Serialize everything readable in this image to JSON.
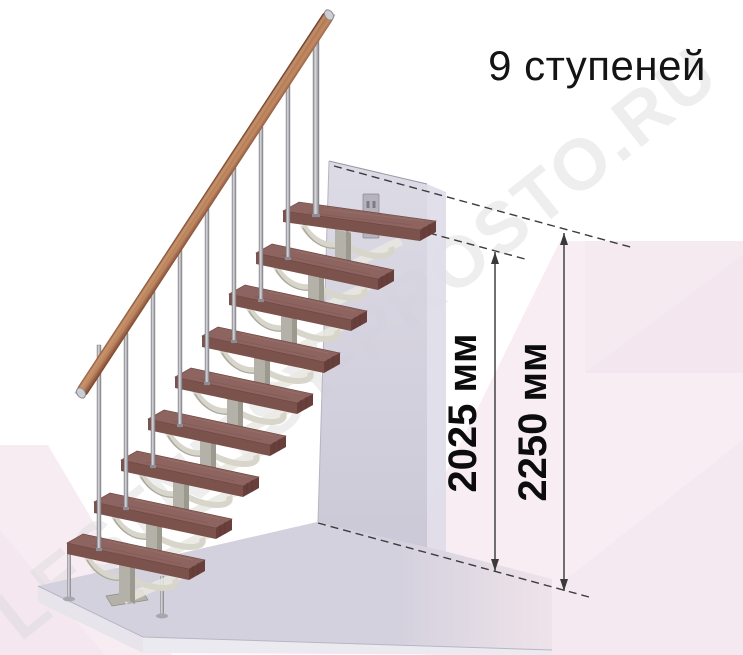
{
  "title": "9 ступеней",
  "watermark": "LESTNITSY-PROSTO.RU",
  "steps_count": 9,
  "dimensions": {
    "inner": {
      "label": "2025 мм",
      "value_mm": 2025
    },
    "outer": {
      "label": "2250 мм",
      "value_mm": 2250
    }
  },
  "colors": {
    "tread_top": "#8d6460",
    "tread_front": "#7b524c",
    "tread_end": "#693f3b",
    "handrail_wood": "#a76f4e",
    "metal_frame": "#b4b1a8",
    "bracket": "#d8d5cb",
    "baluster": "#c9c9cd",
    "wall": "#cfccd9",
    "base_slab": "#d4d1de",
    "background_pink": "#f9edf4",
    "dimension_text": "#0c0c0c"
  }
}
